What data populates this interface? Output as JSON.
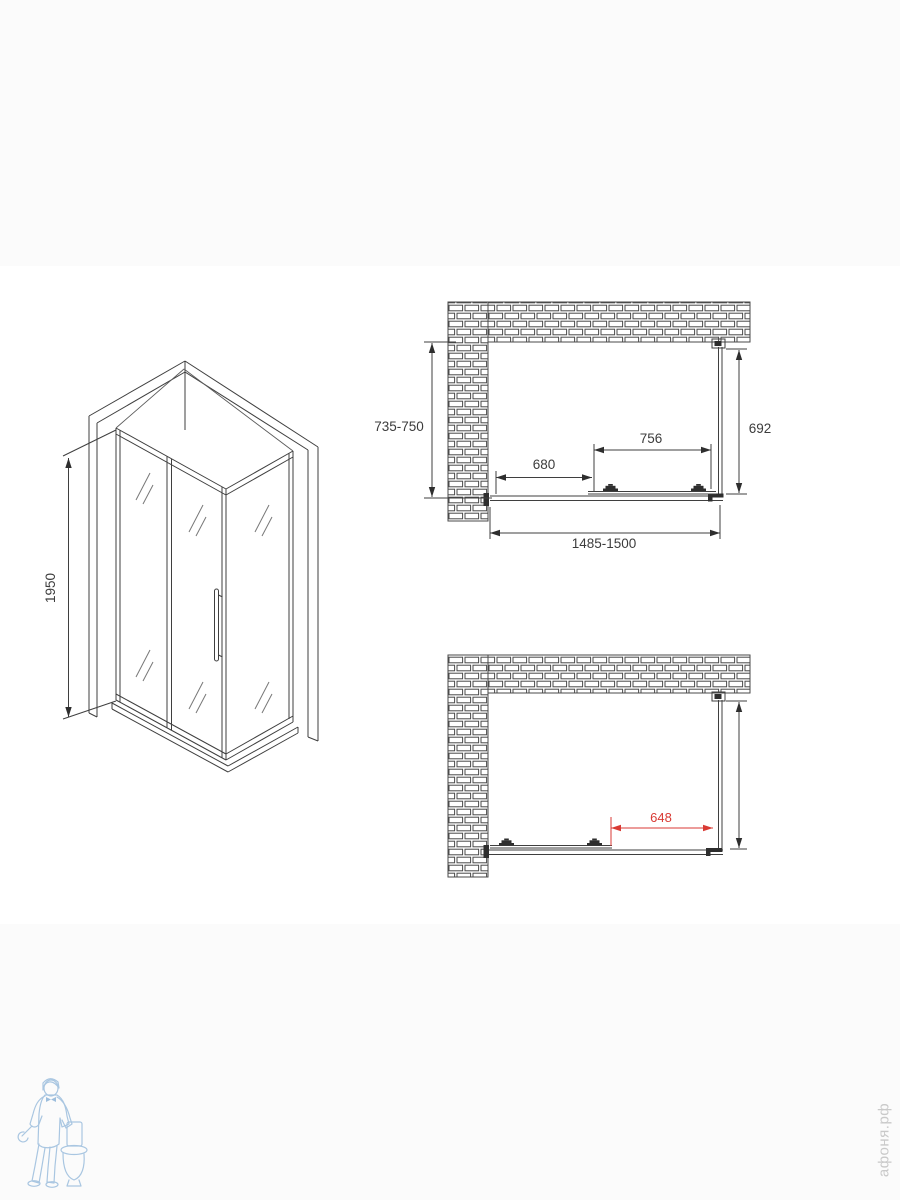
{
  "page": {
    "background": "#ffffff"
  },
  "colors": {
    "line": "#3f3f3f",
    "accent_red": "#d93a34",
    "logo_blue": "#a9c6e1",
    "watermark_gray": "#c9c9c9"
  },
  "isometric_view": {
    "height_dim": "1950"
  },
  "plan_closed": {
    "depth_dim": "735-750",
    "side_dim": "692",
    "door_dim": "756",
    "opening_dim": "680",
    "width_dim": "1485-1500"
  },
  "plan_open": {
    "open_dim": "648"
  },
  "watermark": {
    "site": "афоня.рф"
  }
}
